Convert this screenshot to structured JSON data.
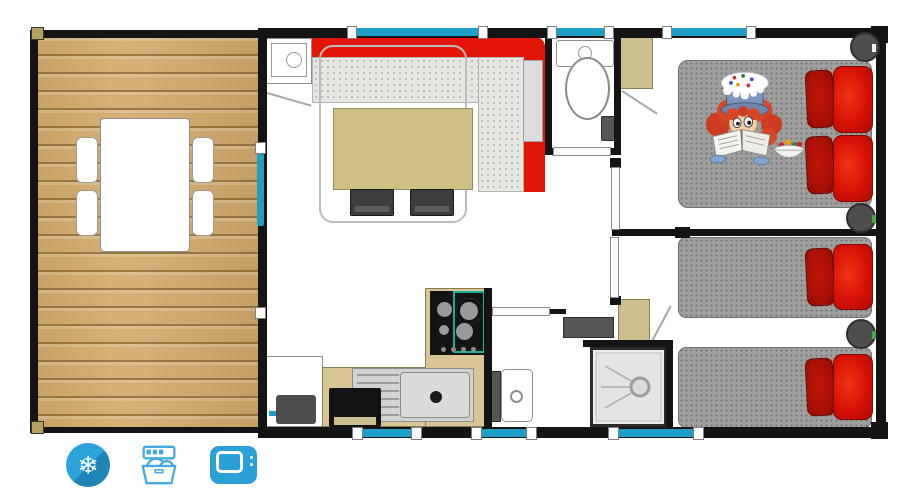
{
  "floorplan": {
    "kind": "mobile-home / chalet top-down floor plan",
    "colors": {
      "wall": "#141414",
      "deck_wood": "#d3ab6c",
      "window_glass": "#1d9fca",
      "sofa_red": "#e31408",
      "pillow_red": "#d81106",
      "pillow_dark_red": "#a30f04",
      "duvet_gray": "#9f9f9f",
      "furniture_tan": "#cdbe8d",
      "hob_trim_teal": "#18b09a",
      "amenity_icon_blue": "#2a9fd8"
    },
    "rooms": [
      {
        "name": "terrace-deck"
      },
      {
        "name": "living-room"
      },
      {
        "name": "kitchen"
      },
      {
        "name": "wc"
      },
      {
        "name": "shower-room"
      },
      {
        "name": "bedroom-double"
      },
      {
        "name": "bedroom-twin"
      }
    ],
    "amenities": [
      {
        "name": "air-conditioning",
        "icon": "snowflake-icon",
        "glyph": "❄"
      },
      {
        "name": "dishwasher",
        "icon": "dishwasher-icon"
      },
      {
        "name": "television",
        "icon": "tv-icon"
      }
    ]
  }
}
